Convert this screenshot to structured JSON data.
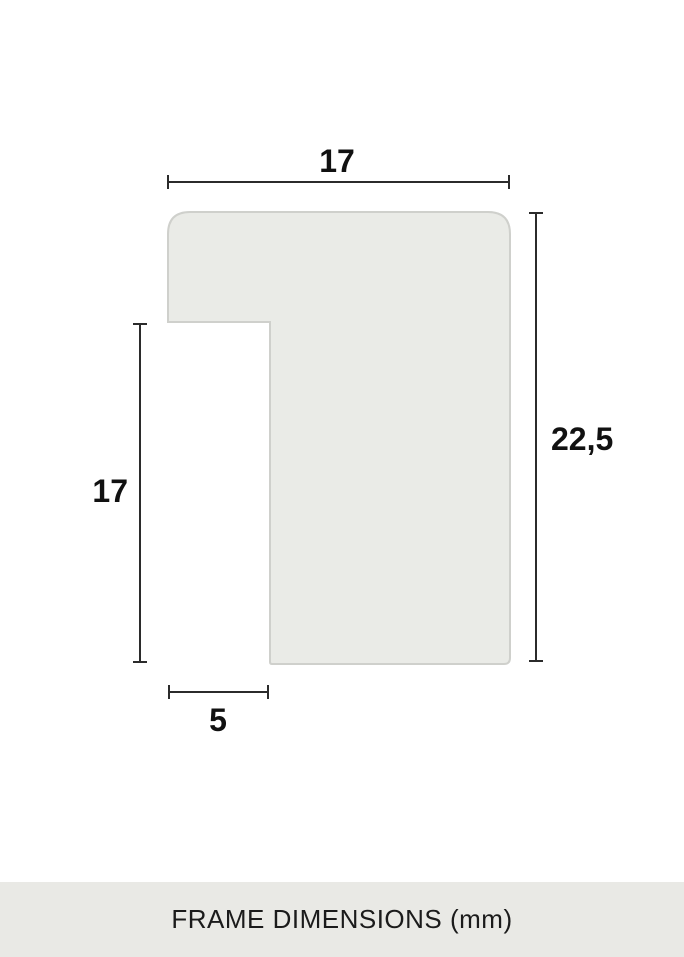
{
  "diagram": {
    "title": "frame profile cross-section",
    "dimensions": {
      "top_width": "17",
      "right_height": "22,5",
      "left_height": "17",
      "bottom_width": "5"
    },
    "unit": "mm",
    "colors": {
      "shape_fill": "#eaebe7",
      "shape_stroke": "#cfd0cc",
      "dimension_line": "#2b2b2b",
      "label_text": "#111111"
    }
  },
  "footer": {
    "label": "FRAME DIMENSIONS (mm)",
    "background": "#e9e9e5"
  }
}
